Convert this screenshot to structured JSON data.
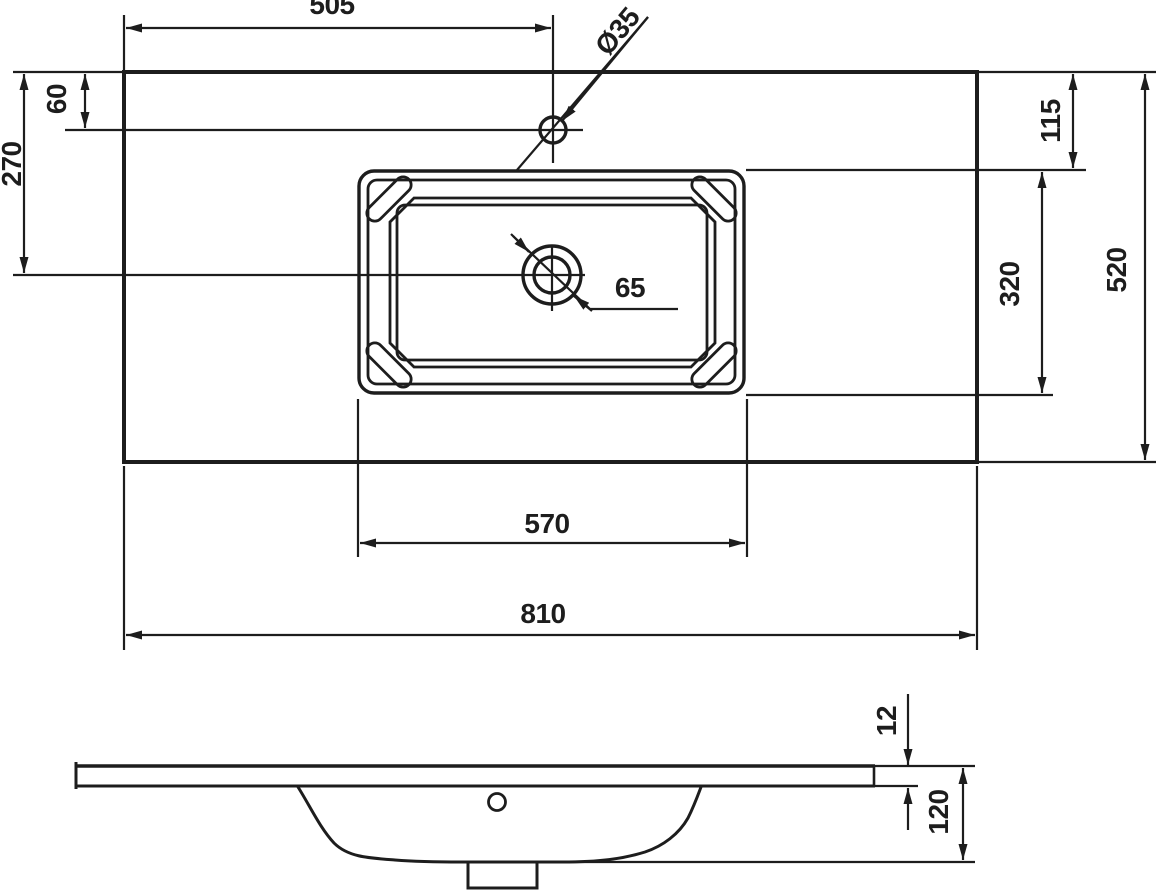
{
  "drawing": {
    "type": "washbasin-dimension-drawing",
    "ink_color": "#1d1d1d",
    "background_color": "#ffffff",
    "top_view": {
      "labels": {
        "faucet_offset_from_left": "505",
        "faucet_hole_diameter": "Ø35",
        "faucet_offset_from_front": "60",
        "drain_offset_from_front": "270",
        "basin_inset_from_front": "115",
        "basin_depth": "320",
        "total_depth": "520",
        "drain_diameter": "65",
        "basin_width": "570",
        "total_width": "810"
      }
    },
    "side_view": {
      "labels": {
        "slab_thickness": "12",
        "total_height": "120"
      }
    }
  }
}
